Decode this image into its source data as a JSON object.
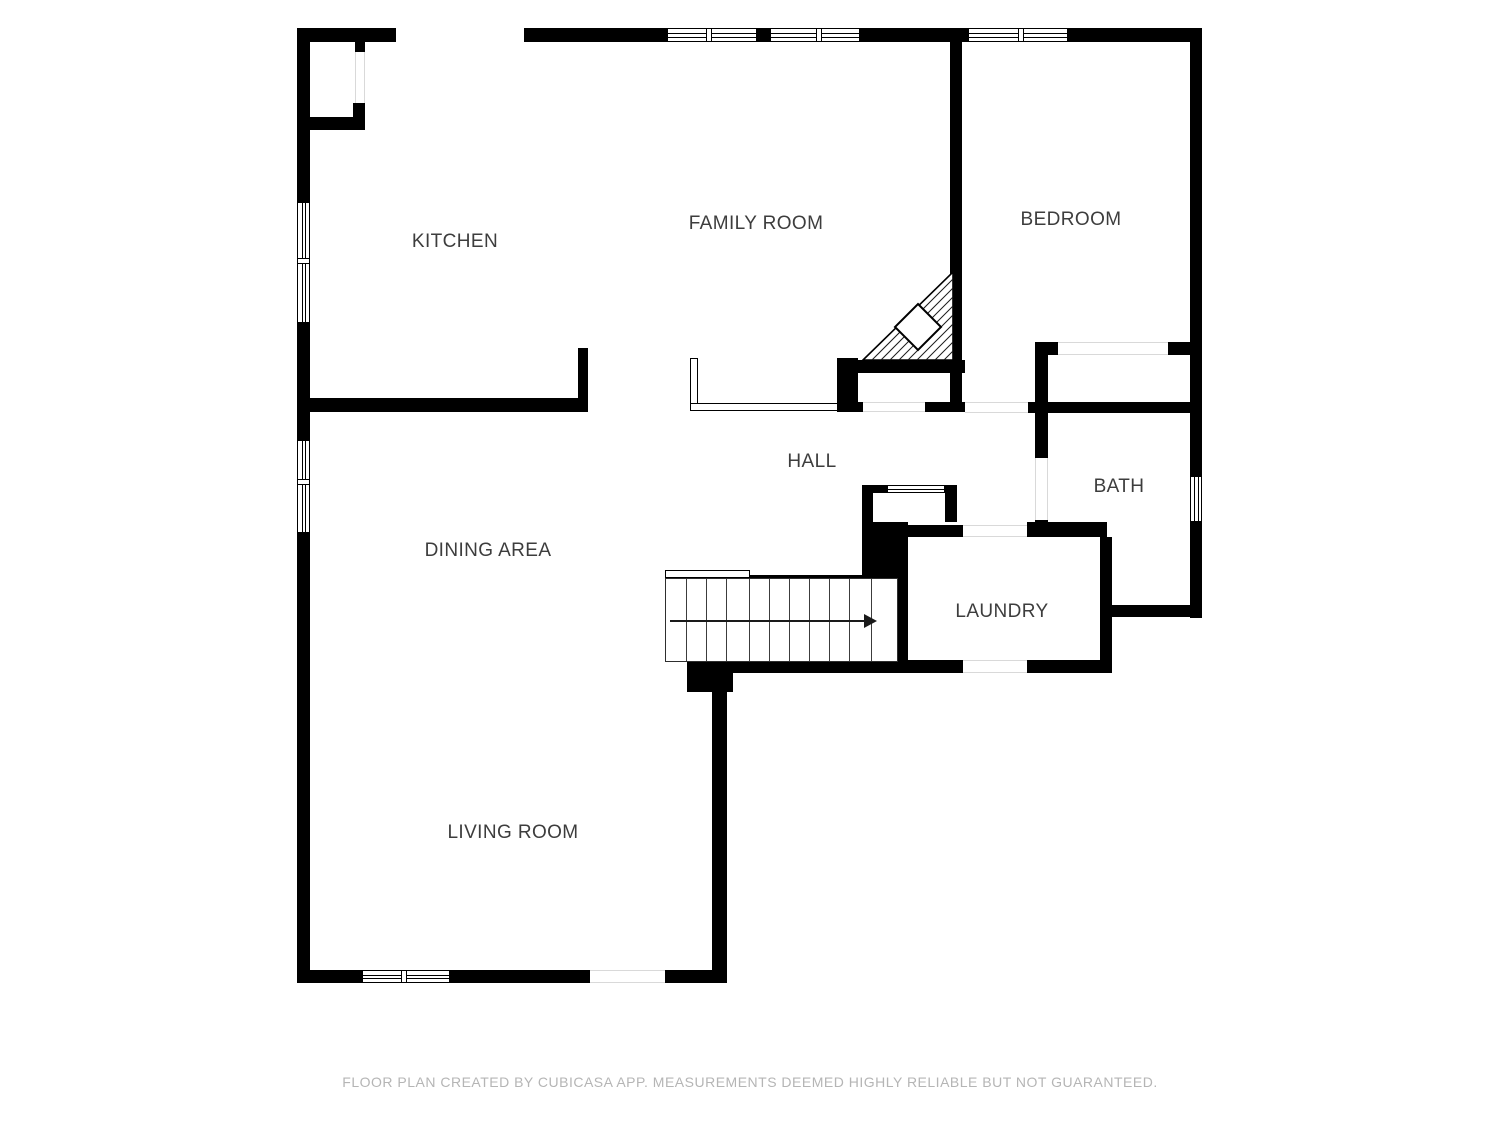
{
  "page": {
    "background": "#ffffff"
  },
  "footer": {
    "text": "FLOOR PLAN CREATED BY CUBICASA APP. MEASUREMENTS DEEMED HIGHLY RELIABLE BUT NOT GUARANTEED."
  },
  "colors": {
    "wall": "#000000",
    "label_text": "#3d3d3d",
    "footer_text": "#b5b5b5",
    "threshold_line": "#d9d9d9",
    "stair_line": "#3c3c3c",
    "arrow": "#1a1a1a"
  },
  "plan": {
    "rooms": [
      "KITCHEN",
      "FAMILY ROOM",
      "BEDROOM",
      "HALL",
      "BATH",
      "DINING AREA",
      "LAUNDRY",
      "LIVING ROOM"
    ],
    "labels": [
      {
        "text": "KITCHEN",
        "x": 455,
        "y": 242
      },
      {
        "text": "FAMILY ROOM",
        "x": 756,
        "y": 224
      },
      {
        "text": "BEDROOM",
        "x": 1071,
        "y": 220
      },
      {
        "text": "HALL",
        "x": 812,
        "y": 462
      },
      {
        "text": "BATH",
        "x": 1119,
        "y": 487
      },
      {
        "text": "DINING AREA",
        "x": 488,
        "y": 551
      },
      {
        "text": "LAUNDRY",
        "x": 1002,
        "y": 612
      },
      {
        "text": "LIVING ROOM",
        "x": 513,
        "y": 833
      }
    ],
    "walls": [
      [
        297,
        28,
        99,
        14
      ],
      [
        524,
        28,
        143,
        14
      ],
      [
        757,
        28,
        13,
        14
      ],
      [
        860,
        28,
        108,
        14
      ],
      [
        1068,
        28,
        134,
        14
      ],
      [
        297,
        28,
        13,
        174
      ],
      [
        297,
        323,
        13,
        117
      ],
      [
        297,
        533,
        13,
        450
      ],
      [
        1190,
        28,
        12,
        448
      ],
      [
        1190,
        522,
        12,
        96
      ],
      [
        355,
        42,
        10,
        10
      ],
      [
        353,
        103,
        12,
        14
      ],
      [
        310,
        117,
        55,
        13
      ],
      [
        297,
        398,
        291,
        14
      ],
      [
        578,
        348,
        10,
        64
      ],
      [
        950,
        28,
        12,
        384
      ],
      [
        837,
        358,
        21,
        54
      ],
      [
        837,
        360,
        128,
        13
      ],
      [
        837,
        402,
        28,
        10
      ],
      [
        925,
        402,
        42,
        10
      ],
      [
        1028,
        402,
        174,
        11
      ],
      [
        1035,
        342,
        23,
        13
      ],
      [
        1168,
        342,
        24,
        13
      ],
      [
        1035,
        342,
        13,
        116
      ],
      [
        1035,
        520,
        13,
        17
      ],
      [
        862,
        485,
        11,
        43
      ],
      [
        862,
        485,
        25,
        8
      ],
      [
        945,
        485,
        12,
        8
      ],
      [
        945,
        493,
        12,
        29
      ],
      [
        862,
        522,
        46,
        58
      ],
      [
        898,
        525,
        65,
        12
      ],
      [
        1027,
        522,
        80,
        15
      ],
      [
        898,
        537,
        10,
        125
      ],
      [
        1100,
        537,
        12,
        136
      ],
      [
        1108,
        605,
        94,
        12
      ],
      [
        748,
        575,
        114,
        13
      ],
      [
        733,
        660,
        230,
        13
      ],
      [
        1027,
        660,
        85,
        13
      ],
      [
        687,
        662,
        46,
        30
      ],
      [
        712,
        690,
        15,
        293
      ],
      [
        297,
        970,
        65,
        13
      ],
      [
        450,
        970,
        140,
        13
      ],
      [
        665,
        970,
        62,
        13
      ]
    ],
    "windows": [
      {
        "x": 297,
        "y": 202,
        "w": 13,
        "h": 121,
        "dir": "v",
        "mullions": [
          55
        ]
      },
      {
        "x": 297,
        "y": 440,
        "w": 13,
        "h": 93,
        "dir": "v",
        "mullions": [
          38
        ]
      },
      {
        "x": 667,
        "y": 28,
        "w": 90,
        "h": 14,
        "dir": "h",
        "mullions": [
          38
        ]
      },
      {
        "x": 770,
        "y": 28,
        "w": 90,
        "h": 14,
        "dir": "h",
        "mullions": [
          45
        ]
      },
      {
        "x": 968,
        "y": 28,
        "w": 100,
        "h": 14,
        "dir": "h",
        "mullions": [
          49
        ]
      },
      {
        "x": 1190,
        "y": 476,
        "w": 12,
        "h": 46,
        "dir": "v",
        "mullions": []
      },
      {
        "x": 887,
        "y": 485,
        "w": 58,
        "h": 8,
        "dir": "h",
        "mullions": []
      },
      {
        "x": 362,
        "y": 970,
        "w": 88,
        "h": 13,
        "dir": "h",
        "mullions": [
          38
        ]
      }
    ],
    "openings": [
      {
        "x": 863,
        "y": 402,
        "w": 62,
        "h": 10,
        "dir": "h"
      },
      {
        "x": 965,
        "y": 402,
        "w": 63,
        "h": 11,
        "dir": "h"
      },
      {
        "x": 1058,
        "y": 342,
        "w": 110,
        "h": 13,
        "dir": "h"
      },
      {
        "x": 1035,
        "y": 458,
        "w": 13,
        "h": 62,
        "dir": "v"
      },
      {
        "x": 963,
        "y": 525,
        "w": 64,
        "h": 12,
        "dir": "h"
      },
      {
        "x": 963,
        "y": 660,
        "w": 64,
        "h": 13,
        "dir": "h"
      },
      {
        "x": 355,
        "y": 52,
        "w": 10,
        "h": 51,
        "dir": "v"
      },
      {
        "x": 590,
        "y": 970,
        "w": 75,
        "h": 13,
        "dir": "h"
      }
    ],
    "kneewalls": [
      [
        690,
        358,
        8,
        53
      ],
      [
        690,
        403,
        148,
        8
      ],
      [
        665,
        570,
        85,
        8
      ]
    ],
    "stairs": {
      "x": 665,
      "y": 578,
      "w": 233,
      "h": 84,
      "steps": [
        20,
        40,
        60,
        83,
        103,
        123,
        143,
        163,
        183,
        205
      ],
      "arrow": {
        "y": 41,
        "x1": 4,
        "x2": 198,
        "head_w": 13
      }
    },
    "winder": {
      "x": 850,
      "y": 260,
      "w": 120,
      "h": 110,
      "triangle": [
        [
          13,
          100
        ],
        [
          103,
          12
        ],
        [
          103,
          100
        ]
      ],
      "diamond": [
        [
          68,
          44
        ],
        [
          91,
          67
        ],
        [
          68,
          90
        ],
        [
          45,
          67
        ]
      ],
      "hatch_step": 9
    }
  }
}
